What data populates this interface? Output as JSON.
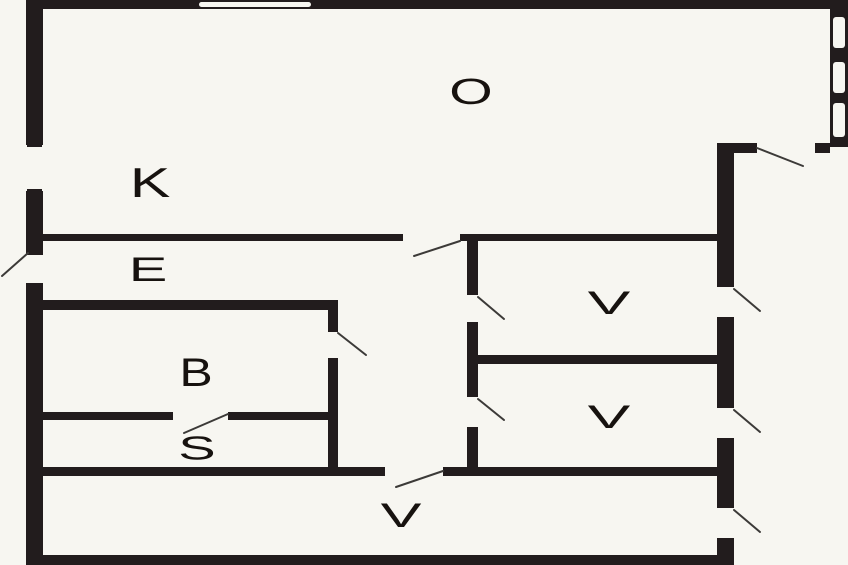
{
  "colors": {
    "background": "#f7f6f1",
    "wall": "#221c1d",
    "label": "#17120f",
    "door_swing": "#3c3a38"
  },
  "rooms": [
    {
      "id": "o",
      "label": "O"
    },
    {
      "id": "k",
      "label": "K"
    },
    {
      "id": "e",
      "label": "E"
    },
    {
      "id": "b",
      "label": "B"
    },
    {
      "id": "s",
      "label": "S"
    },
    {
      "id": "v-upper",
      "label": "V"
    },
    {
      "id": "v-middle",
      "label": "V"
    },
    {
      "id": "v-bottom",
      "label": "V"
    }
  ]
}
